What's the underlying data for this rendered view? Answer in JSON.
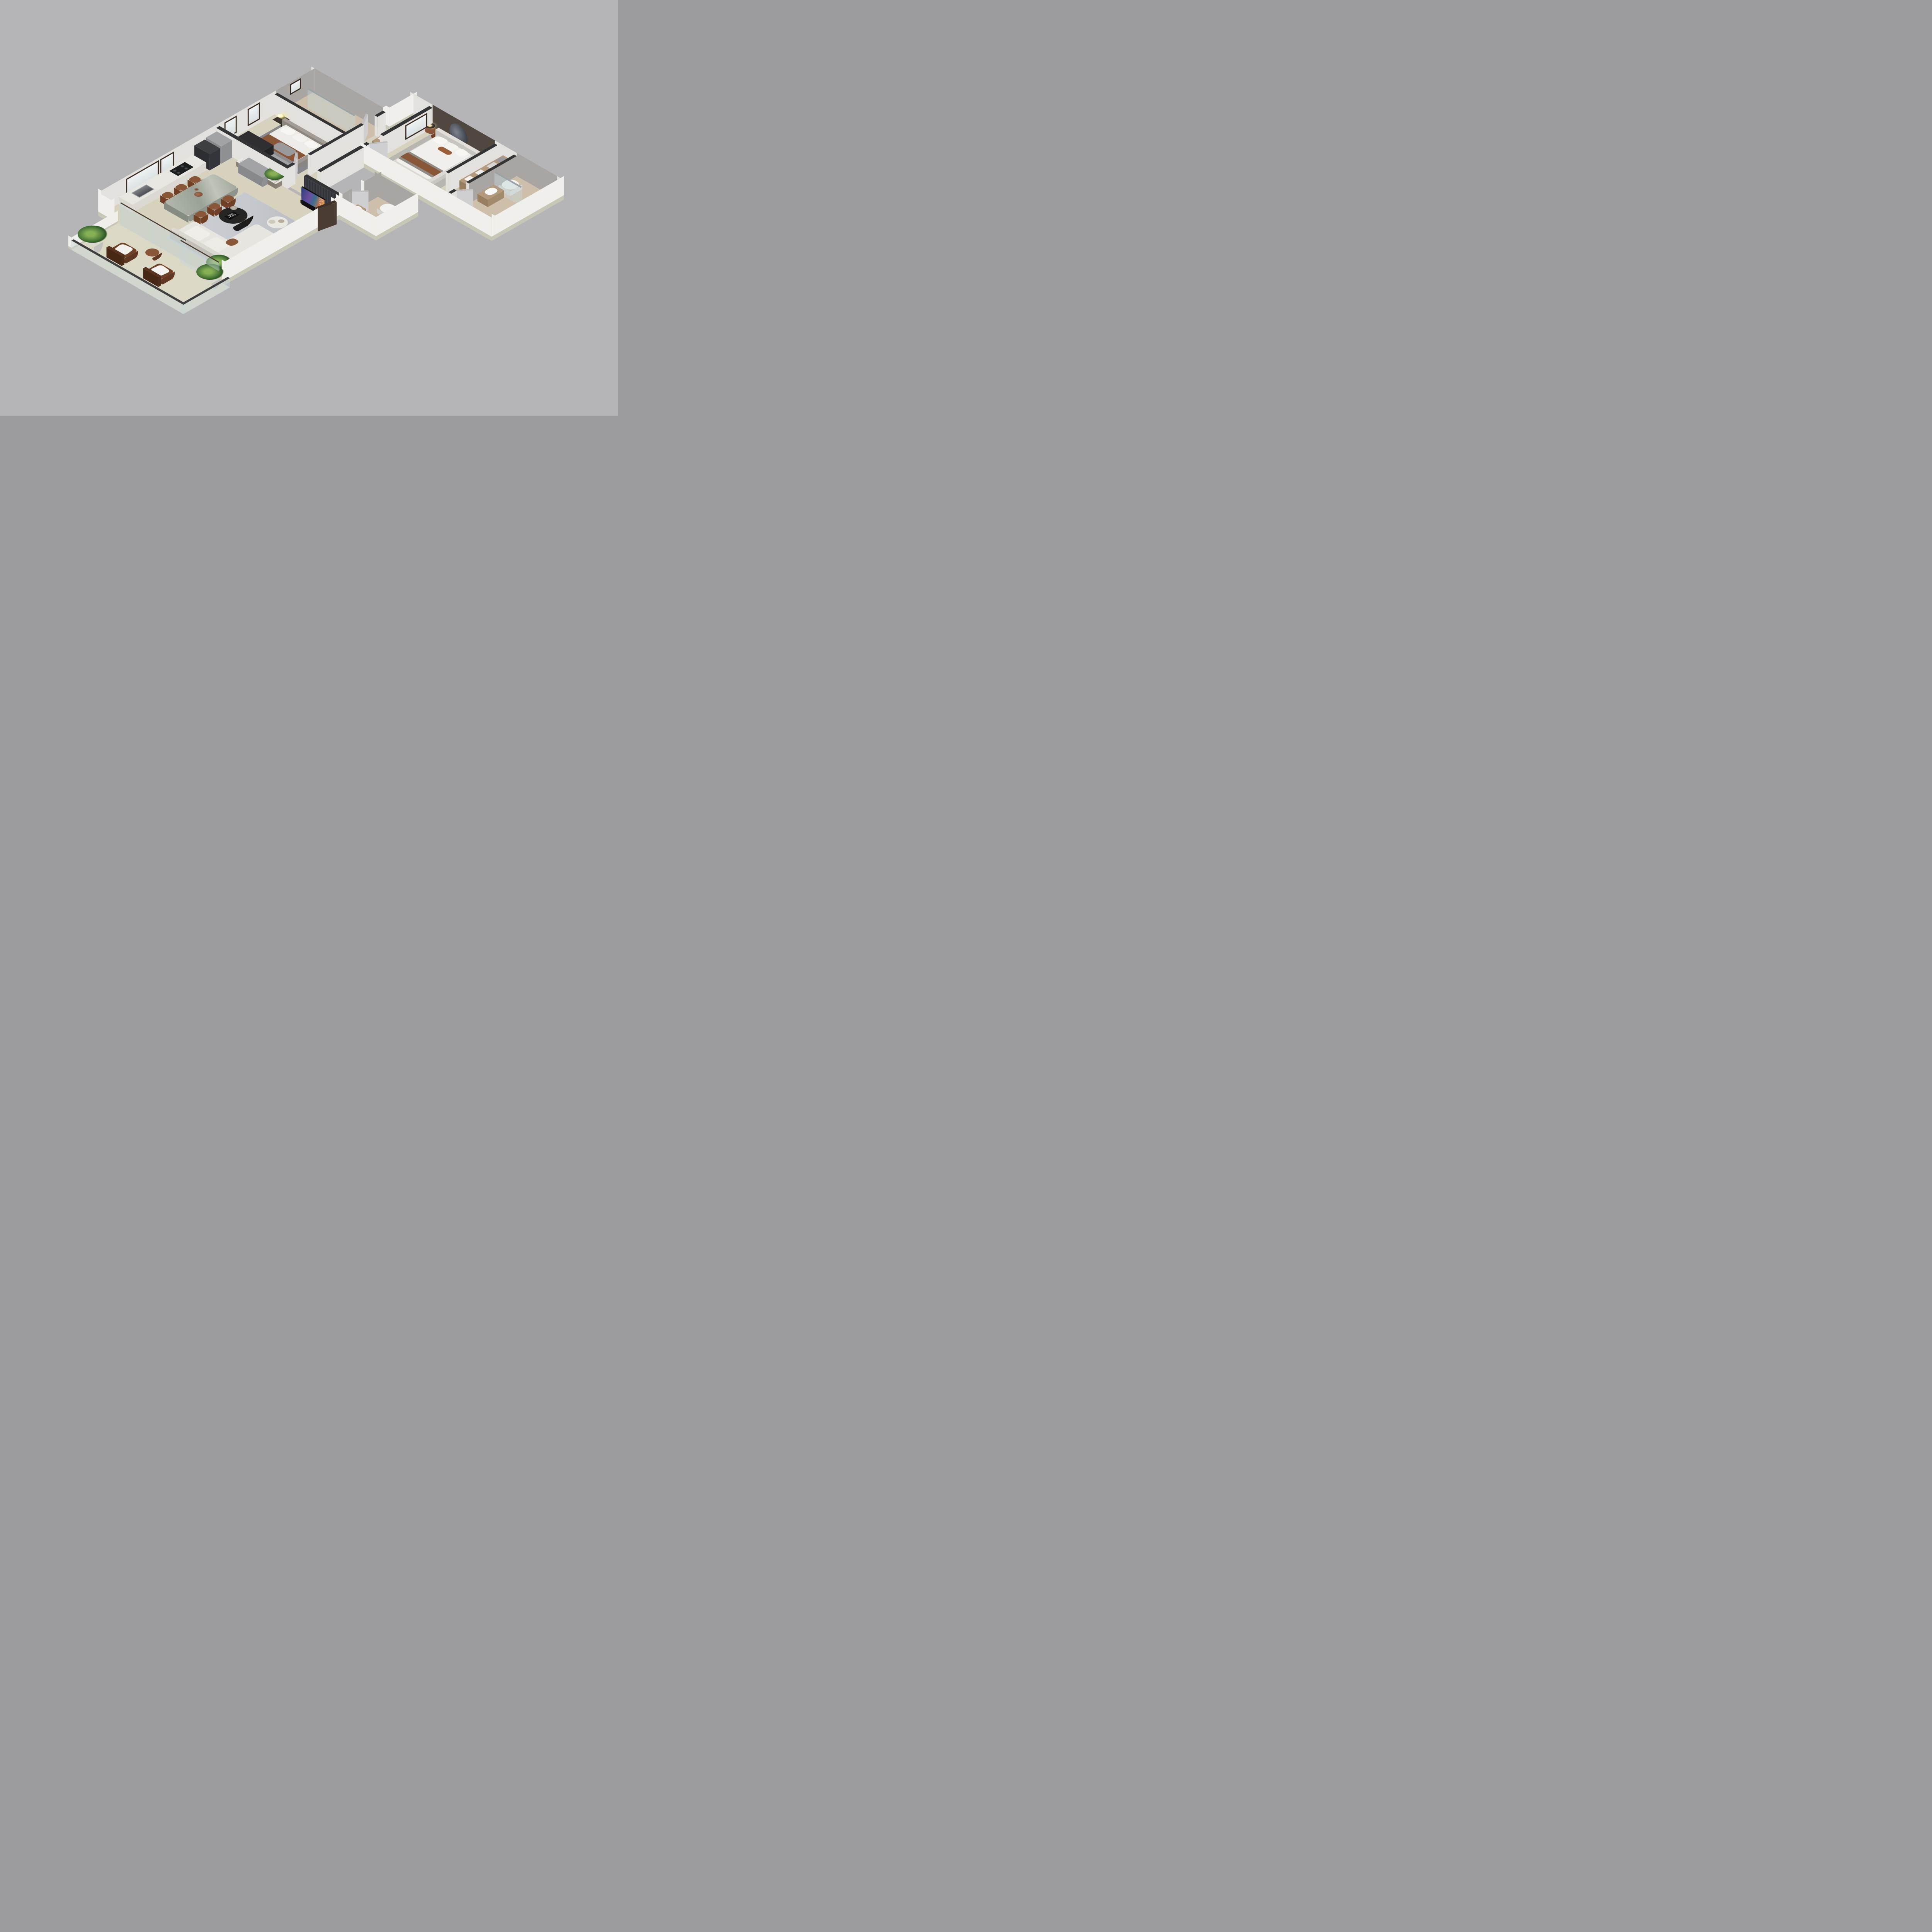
{
  "scene": {
    "kind": "isometric-3d-floor-plan-render",
    "rooms": [
      "balcony",
      "living-room",
      "dining-area",
      "kitchen",
      "second-bedroom",
      "second-bathroom",
      "hallway",
      "laundry-nook",
      "master-bedroom",
      "walk-in-closet",
      "ensuite-bathroom",
      "guest-wc"
    ]
  },
  "book": {
    "line1": "TOM",
    "line2": "FORD"
  },
  "tv": {
    "label": "QLED TV"
  },
  "colors": {
    "bg": "#b5b5b7",
    "cap": "#333436",
    "wall": "#f0efec",
    "wallin": "#e3e1dd",
    "basestrip": "#c8c7b5",
    "stone": "#a8a5a2",
    "accent": "#50483f",
    "slat1": "#323338",
    "slat2": "#3e4046",
    "floor": "#d6d2bd",
    "floorlite": "#dcd8c6",
    "wood": "#cdbfa9",
    "woodd": "#b49a7c",
    "rugliv": "#c5c8cc",
    "rugbed": "#85878b",
    "rugmas": "#b8b6b1",
    "sofa": "#e7e5e0",
    "leather": "#8a5638",
    "leatherd": "#6f4026",
    "marble": "#a8afa2",
    "marblewhite": "#e9e7e2",
    "dark": "#2b2927",
    "doorlite": "#cfcfd1",
    "doordark": "#4a3c32",
    "glass": "rgba(195,212,215,0.45)",
    "glow": "#f4e79a",
    "green": "#4c7a39",
    "white": "#f4f3f0",
    "steel": "#73767a",
    "tvframe": "#101012",
    "counter": "#e8e6e1",
    "cabinets": "#a2a3a7",
    "fridge": "#3d3f43"
  }
}
